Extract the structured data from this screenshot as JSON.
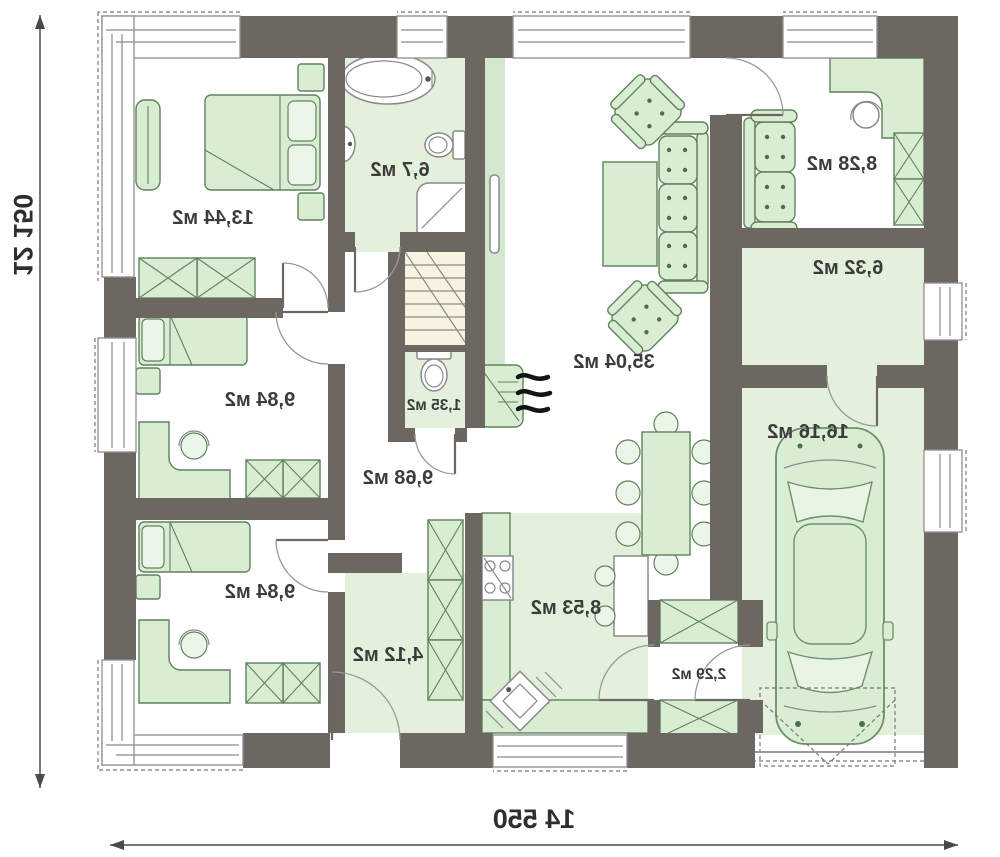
{
  "plan": {
    "dims": {
      "width": "14 550",
      "height": "12 150"
    },
    "rooms": {
      "bedroom_large": "13,44 м2",
      "bathroom": "6,7 м2",
      "office": "8,28 м2",
      "boiler": "6,32 м2",
      "garage": "16,16 м2",
      "living": "35,04 м2",
      "corridor": "9,68 м2",
      "wc": "1,35 м2",
      "bedroom_mid": "9,84 м2",
      "bedroom_low": "9,84 м2",
      "entry": "4,12 м2",
      "kitchen": "8,53 м2",
      "mudroom": "2,29 м2"
    },
    "colors": {
      "wall": "#6d6761",
      "floor_green": "#e3f0dc",
      "furniture": "#d9edd3",
      "stairs_floor": "#f8f3e0",
      "text": "#3c3c3c"
    }
  }
}
